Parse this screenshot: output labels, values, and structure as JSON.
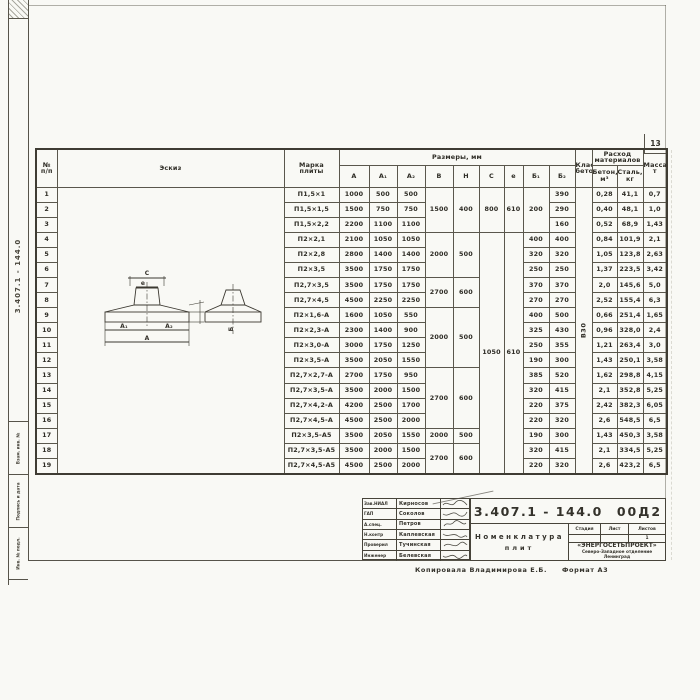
{
  "page": {
    "number": "13"
  },
  "side_margin": {
    "doc_number": "3.407.1 - 144.0",
    "boxes": [
      "Взам. инв. №",
      "Подпись и дата",
      "Инв. № подл."
    ]
  },
  "table": {
    "headers": {
      "num": "№\nп/п",
      "sketch": "Эскиз",
      "marka": "Марка\nплиты",
      "sizes": "Размеры,  мм",
      "dims": [
        "А",
        "А₁",
        "А₂",
        "В",
        "Н",
        "С",
        "е",
        "Б₁",
        "Б₂"
      ],
      "concrete_class": "Класс\nбетона",
      "consumption": "Расход\nматериалов",
      "concrete": "Бетон,\nм³",
      "steel": "Сталь,\nкг",
      "mass": "Масса,\nт"
    },
    "concrete_class_value": "В30",
    "rows": [
      {
        "n": "1",
        "marka": "П1,5×1",
        "a": "1000",
        "a1": "500",
        "a2": "500",
        "b": "1500",
        "h": "400",
        "c": "800",
        "e": "610",
        "b1": "200",
        "b2": "390",
        "beton": "0,28",
        "stal": "41,1",
        "massa": "0,7"
      },
      {
        "n": "2",
        "marka": "П1,5×1,5",
        "a": "1500",
        "a1": "750",
        "a2": "750",
        "b2": "290",
        "beton": "0,40",
        "stal": "48,1",
        "massa": "1,0"
      },
      {
        "n": "3",
        "marka": "П1,5×2,2",
        "a": "2200",
        "a1": "1100",
        "a2": "1100",
        "b2": "160",
        "beton": "0,52",
        "stal": "68,9",
        "massa": "1,43"
      },
      {
        "n": "4",
        "marka": "П2×2,1",
        "a": "2100",
        "a1": "1050",
        "a2": "1050",
        "b": "2000",
        "h": "500",
        "c": "1050",
        "e": "610",
        "b1": "400",
        "b2": "400",
        "beton": "0,84",
        "stal": "101,9",
        "massa": "2,1"
      },
      {
        "n": "5",
        "marka": "П2×2,8",
        "a": "2800",
        "a1": "1400",
        "a2": "1400",
        "b1": "320",
        "b2": "320",
        "beton": "1,05",
        "stal": "123,8",
        "massa": "2,63"
      },
      {
        "n": "6",
        "marka": "П2×3,5",
        "a": "3500",
        "a1": "1750",
        "a2": "1750",
        "b1": "250",
        "b2": "250",
        "beton": "1,37",
        "stal": "223,5",
        "massa": "3,42"
      },
      {
        "n": "7",
        "marka": "П2,7×3,5",
        "a": "3500",
        "a1": "1750",
        "a2": "1750",
        "b": "2700",
        "h": "600",
        "b1": "370",
        "b2": "370",
        "beton": "2,0",
        "stal": "145,6",
        "massa": "5,0"
      },
      {
        "n": "8",
        "marka": "П2,7×4,5",
        "a": "4500",
        "a1": "2250",
        "a2": "2250",
        "b1": "270",
        "b2": "270",
        "beton": "2,52",
        "stal": "155,4",
        "massa": "6,3"
      },
      {
        "n": "9",
        "marka": "П2×1,6-А",
        "a": "1600",
        "a1": "1050",
        "a2": "550",
        "b": "2000",
        "h": "500",
        "b1": "400",
        "b2": "500",
        "beton": "0,66",
        "stal": "251,4",
        "massa": "1,65"
      },
      {
        "n": "10",
        "marka": "П2×2,3-А",
        "a": "2300",
        "a1": "1400",
        "a2": "900",
        "b1": "325",
        "b2": "430",
        "beton": "0,96",
        "stal": "328,0",
        "massa": "2,4"
      },
      {
        "n": "11",
        "marka": "П2×3,0-А",
        "a": "3000",
        "a1": "1750",
        "a2": "1250",
        "b1": "250",
        "b2": "355",
        "beton": "1,21",
        "stal": "263,4",
        "massa": "3,0"
      },
      {
        "n": "12",
        "marka": "П2×3,5-А",
        "a": "3500",
        "a1": "2050",
        "a2": "1550",
        "b1": "190",
        "b2": "300",
        "beton": "1,43",
        "stal": "250,1",
        "massa": "3,58"
      },
      {
        "n": "13",
        "marka": "П2,7×2,7-А",
        "a": "2700",
        "a1": "1750",
        "a2": "950",
        "b": "2700",
        "h": "600",
        "b1": "385",
        "b2": "520",
        "beton": "1,62",
        "stal": "298,8",
        "massa": "4,15"
      },
      {
        "n": "14",
        "marka": "П2,7×3,5-А",
        "a": "3500",
        "a1": "2000",
        "a2": "1500",
        "b1": "320",
        "b2": "415",
        "beton": "2,1",
        "stal": "352,8",
        "massa": "5,25"
      },
      {
        "n": "15",
        "marka": "П2,7×4,2-А",
        "a": "4200",
        "a1": "2500",
        "a2": "1700",
        "b1": "220",
        "b2": "375",
        "beton": "2,42",
        "stal": "382,3",
        "massa": "6,05"
      },
      {
        "n": "16",
        "marka": "П2,7×4,5-А",
        "a": "4500",
        "a1": "2500",
        "a2": "2000",
        "b1": "220",
        "b2": "320",
        "beton": "2,6",
        "stal": "548,5",
        "massa": "6,5"
      },
      {
        "n": "17",
        "marka": "П2×3,5-А5",
        "a": "3500",
        "a1": "2050",
        "a2": "1550",
        "b": "2000",
        "h": "500",
        "b1": "190",
        "b2": "300",
        "beton": "1,43",
        "stal": "450,3",
        "massa": "3,58"
      },
      {
        "n": "18",
        "marka": "П2,7×3,5-А5",
        "a": "3500",
        "a1": "2000",
        "a2": "1500",
        "b": "2700",
        "h": "600",
        "b1": "320",
        "b2": "415",
        "beton": "2,1",
        "stal": "334,5",
        "massa": "5,25"
      },
      {
        "n": "19",
        "marka": "П2,7×4,5-А5",
        "a": "4500",
        "a1": "2500",
        "a2": "2000",
        "b1": "220",
        "b2": "320",
        "beton": "2,6",
        "stal": "423,2",
        "massa": "6,5"
      }
    ]
  },
  "sketch_labels": {
    "c": "С",
    "e": "е",
    "a1": "А₁",
    "a2": "А₂",
    "a": "А",
    "b": "Б"
  },
  "titleblock": {
    "doc_number": "3.407.1 - 144.0",
    "sheet_code": "00Д2",
    "title_line1": "Номенклатура",
    "title_line2": "плит",
    "stage_header": "Стадия",
    "sheet_header": "Лист",
    "sheets_header": "Листов",
    "sheets_value": "1",
    "org_line1": "«ЭНЕРГОСЕТЬПРОЕКТ»",
    "org_line2": "Северо-Западное отделение",
    "org_line3": "Ленинград",
    "signatures": [
      {
        "role": "Зав.НИАЛ",
        "name": "Кирносов"
      },
      {
        "role": "ГАП",
        "name": "Соколов"
      },
      {
        "role": "А.спец.",
        "name": "Петров"
      },
      {
        "role": "Н.контр",
        "name": "Каплевская"
      },
      {
        "role": "Проверил",
        "name": "Тучинская"
      },
      {
        "role": "Инженер",
        "name": "Белевская"
      }
    ],
    "copied_by": "Копировала  Владимирова Е.Б.",
    "format_note": "Формат А3"
  }
}
